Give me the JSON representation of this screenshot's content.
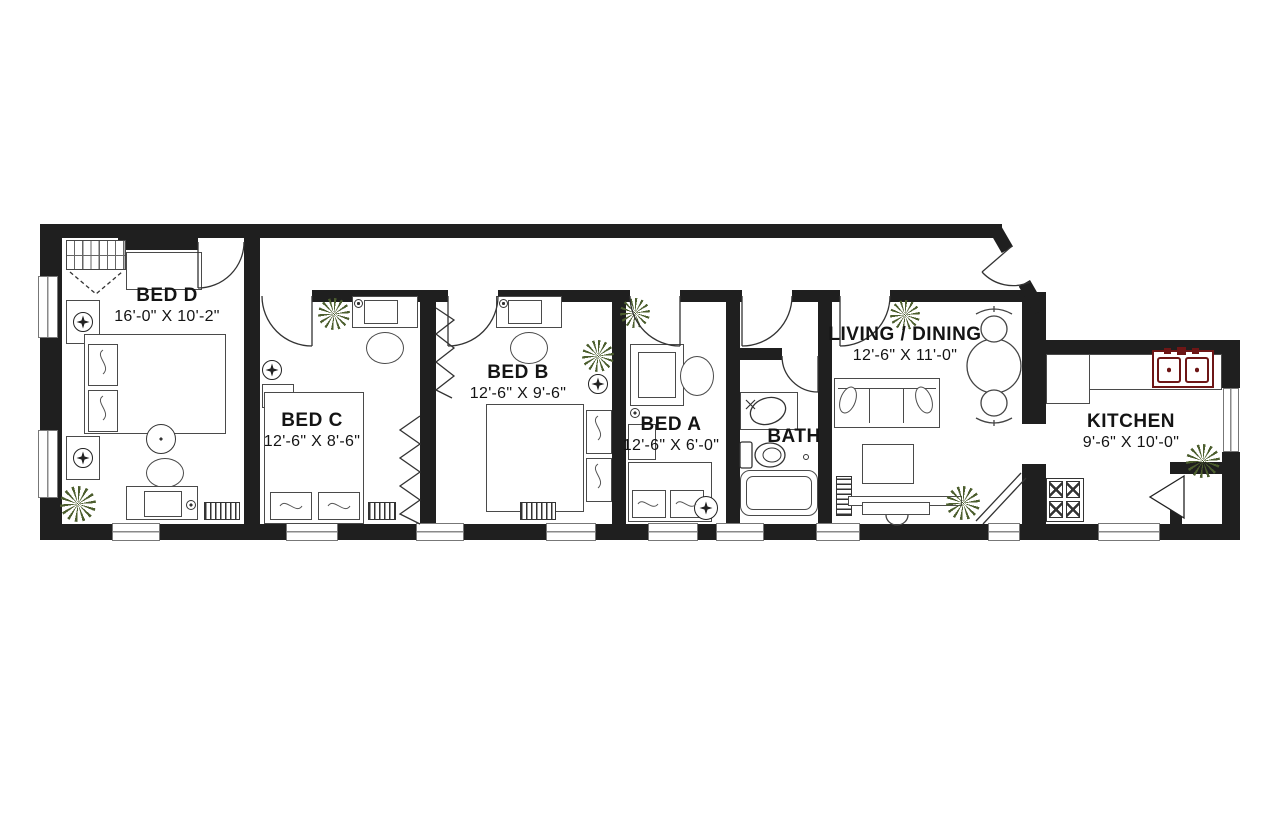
{
  "colors": {
    "wall": "#1f1f1f",
    "furniture_line": "#4a4a4a",
    "plant": "#4c5e2e",
    "sink": "#6e1616",
    "window_line": "#8a8a8a",
    "label": "#141414"
  },
  "icons": {
    "plant": "starburst-houseplant-top-view",
    "light": "ceiling-light-cross-in-circle"
  },
  "floor_plan": {
    "rooms": [
      {
        "name": "BED D",
        "dimensions": "16'-0\" X 10'-2\""
      },
      {
        "name": "BED C",
        "dimensions": "12'-6\" X 8'-6\""
      },
      {
        "name": "BED B",
        "dimensions": "12'-6\" X 9'-6\""
      },
      {
        "name": "BED A",
        "dimensions": "12'-6\" X 6'-0\""
      },
      {
        "name": "BATH",
        "dimensions": ""
      },
      {
        "name": "LIVING / DINING",
        "dimensions": "12'-6\" X 11'-0\""
      },
      {
        "name": "KITCHEN",
        "dimensions": "9'-6\" X 10'-0\""
      }
    ]
  }
}
